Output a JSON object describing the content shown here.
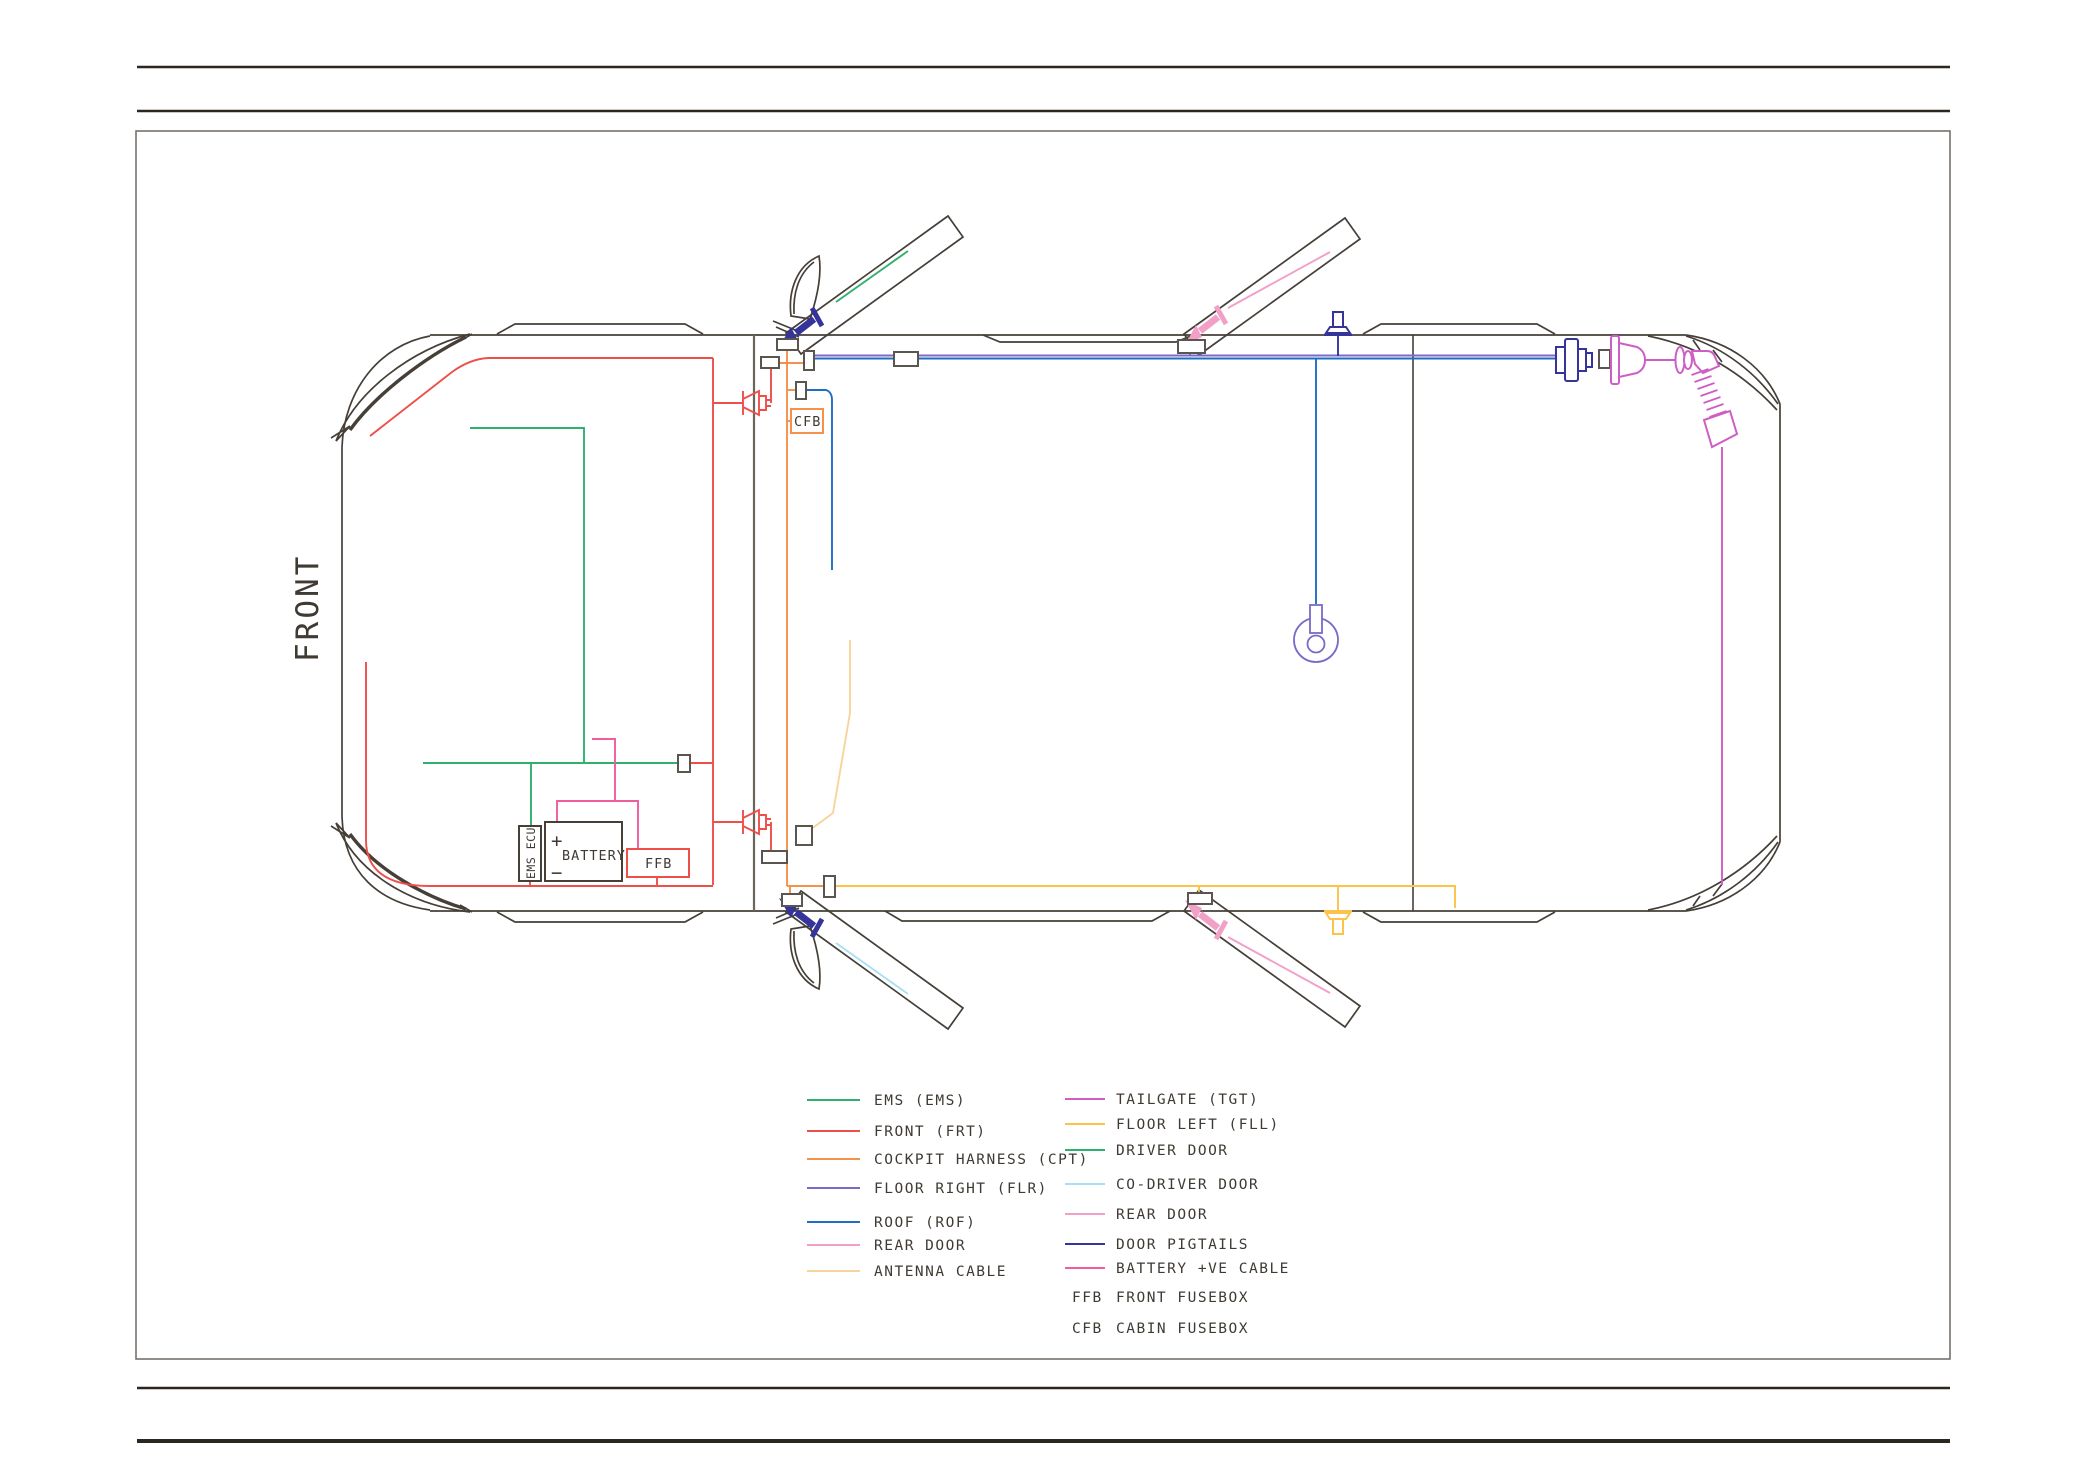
{
  "page": {
    "front_label": "FRONT"
  },
  "engine_bay": {
    "ems_ecu_label": "EMS ECU",
    "battery_label": "BATTERY",
    "battery_plus": "+",
    "battery_minus": "−",
    "ffb_label": "FFB"
  },
  "cabin": {
    "cfb_label": "CFB"
  },
  "legend": {
    "left": [
      {
        "label": "EMS (EMS)",
        "color_key": "ems"
      },
      {
        "label": "FRONT (FRT)",
        "color_key": "frt"
      },
      {
        "label": "COCKPIT HARNESS (CPT)",
        "color_key": "cpt"
      },
      {
        "label": "FLOOR RIGHT (FLR)",
        "color_key": "flr"
      },
      {
        "label": "ROOF (ROF)",
        "color_key": "rof"
      },
      {
        "label": "REAR DOOR",
        "color_key": "rear_door"
      },
      {
        "label": "ANTENNA CABLE",
        "color_key": "antenna"
      }
    ],
    "right": [
      {
        "label": "TAILGATE (TGT)",
        "color_key": "tgt"
      },
      {
        "label": "FLOOR LEFT (FLL)",
        "color_key": "fll"
      },
      {
        "label": "DRIVER DOOR",
        "color_key": "driver_door"
      },
      {
        "label": "CO-DRIVER DOOR",
        "color_key": "codriver_door"
      },
      {
        "label": "REAR DOOR",
        "color_key": "rear_door"
      },
      {
        "label": "DOOR PIGTAILS",
        "color_key": "pigtail"
      },
      {
        "label": "BATTERY +VE CABLE",
        "color_key": "batt"
      }
    ],
    "abbreviations": [
      {
        "abbr": "FFB",
        "label": "FRONT FUSEBOX"
      },
      {
        "abbr": "CFB",
        "label": "CABIN FUSEBOX"
      }
    ]
  },
  "colors": {
    "ems": "#2eb06e",
    "frt": "#ee4f4b",
    "cpt": "#f6914b",
    "flr": "#7b68c8",
    "rof": "#1f6ec6",
    "rear_door": "#f2a0c8",
    "antenna": "#f7d49b",
    "tgt": "#cf5ec4",
    "fll": "#fcc349",
    "driver_door": "#2eb06e",
    "codriver_door": "#a8e0f2",
    "pigtail": "#34349b",
    "batt": "#f05c9e",
    "outline": "#453f38",
    "structure": "#6b655c",
    "connector": "#5a564f",
    "text": "#3f3a33"
  }
}
